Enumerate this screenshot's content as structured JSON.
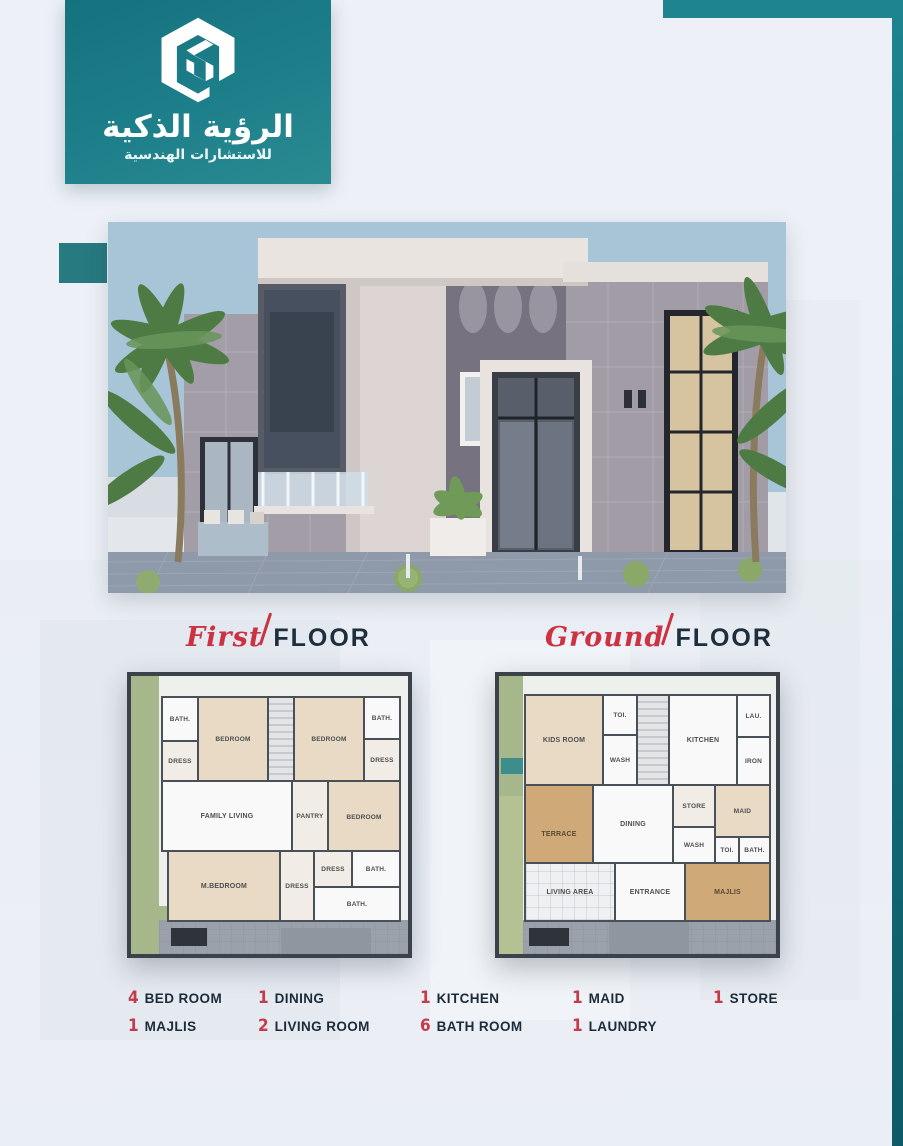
{
  "brand": {
    "title_ar": "الرؤية الذكية",
    "subtitle_ar": "للاستشارات الهندسية",
    "logo_icon": "hexagon-s-monogram"
  },
  "colors": {
    "teal": "#1e8490",
    "teal_dark": "#0e5a68",
    "accent_red": "#c43b4c",
    "navy": "#1d2e3d",
    "page_bg": "#edf1f7"
  },
  "sections": {
    "first_floor": {
      "script": "First",
      "word": "FLOOR"
    },
    "ground_floor": {
      "script": "Ground",
      "word": "FLOOR"
    }
  },
  "plans": {
    "first": {
      "rooms": [
        "BATH.",
        "DRESS",
        "BEDROOM",
        "BEDROOM",
        "BATH.",
        "DRESS",
        "FAMILY LIVING",
        "PANTRY",
        "BEDROOM",
        "M.BEDROOM",
        "DRESS",
        "DRESS",
        "BATH.",
        "BATH."
      ]
    },
    "ground": {
      "rooms": [
        "KIDS ROOM",
        "TOI.",
        "WASH",
        "KITCHEN",
        "LAU.",
        "IRON",
        "TERRACE",
        "DINING",
        "STORE",
        "MAID",
        "WASH",
        "TOI.",
        "BATH.",
        "LIVING AREA",
        "ENTRANCE",
        "MAJLIS"
      ]
    }
  },
  "legend": {
    "row1": [
      {
        "count": "4",
        "label": "BED ROOM"
      },
      {
        "count": "1",
        "label": "DINING"
      },
      {
        "count": "1",
        "label": "KITCHEN"
      },
      {
        "count": "1",
        "label": "MAID"
      },
      {
        "count": "1",
        "label": "STORE"
      }
    ],
    "row2": [
      {
        "count": "1",
        "label": "MAJLIS"
      },
      {
        "count": "2",
        "label": "LIVING ROOM"
      },
      {
        "count": "6",
        "label": "BATH ROOM"
      },
      {
        "count": "1",
        "label": "LAUNDRY"
      }
    ]
  }
}
